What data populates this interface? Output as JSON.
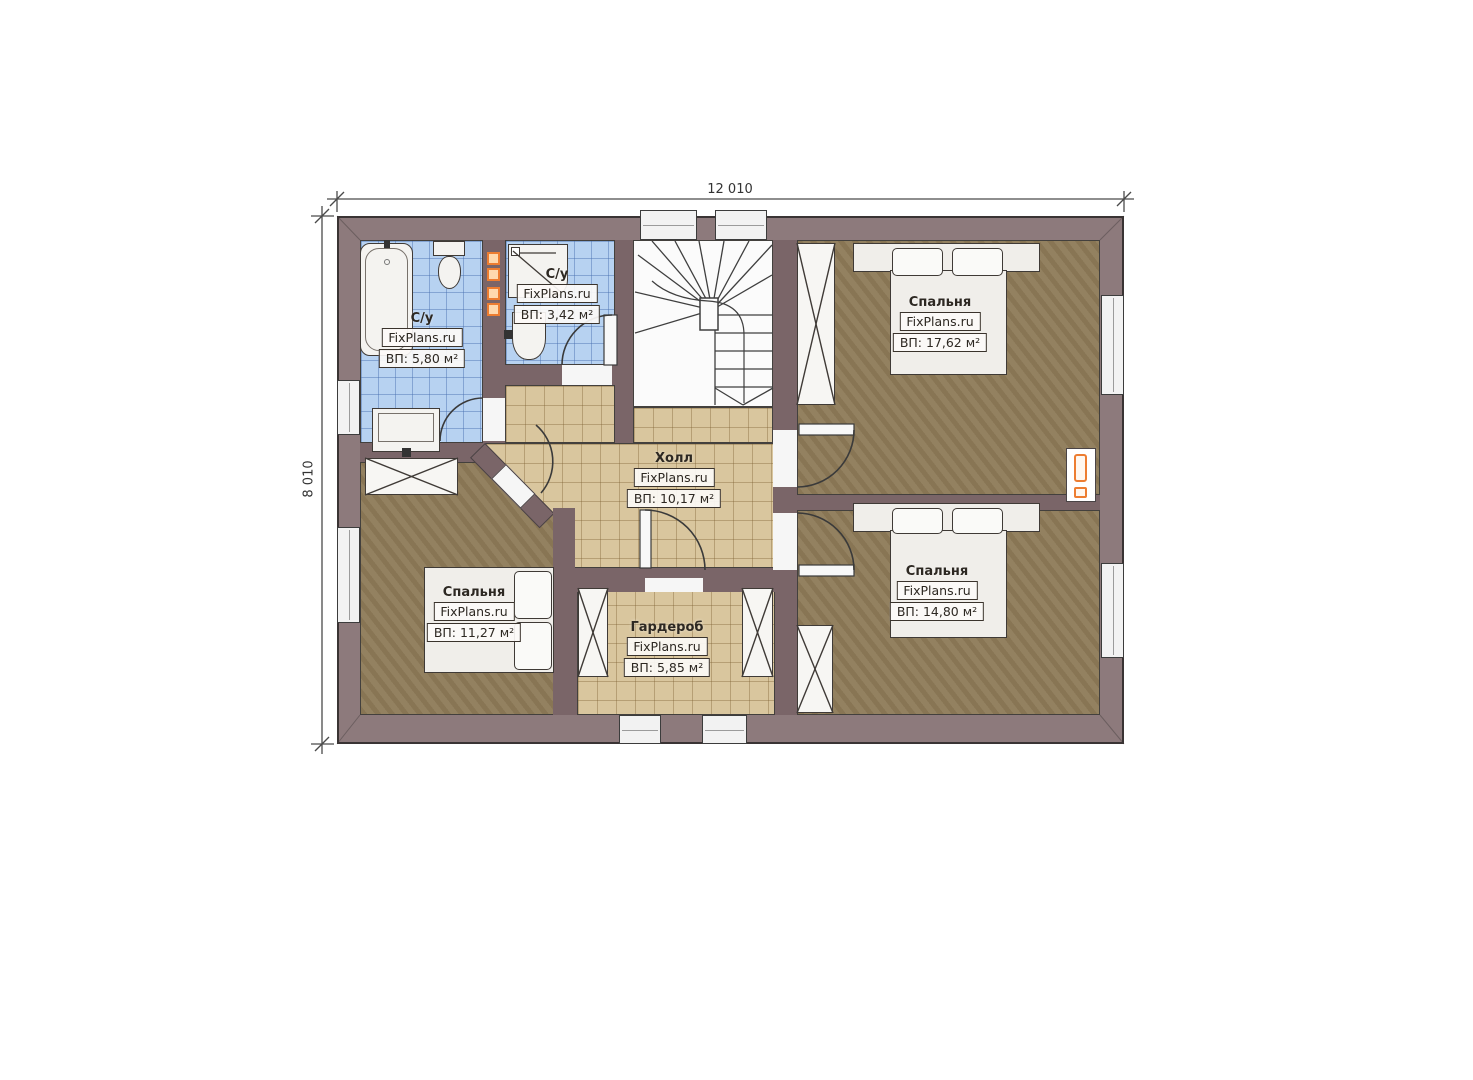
{
  "plan": {
    "watermark": "FixPlans.ru",
    "dimension_width": "12 010",
    "dimension_height": "8 010",
    "rooms": [
      {
        "id": "bathroom-top-left",
        "name": "С/у",
        "area": "ВП: 5,80 м²"
      },
      {
        "id": "bathroom-top-middle",
        "name": "С/у",
        "area": "ВП: 3,42 м²"
      },
      {
        "id": "bedroom-top-right",
        "name": "Спальня",
        "area": "ВП: 17,62 м²"
      },
      {
        "id": "hall",
        "name": "Холл",
        "area": "ВП: 10,17 м²"
      },
      {
        "id": "bedroom-bottom-left",
        "name": "Спальня",
        "area": "ВП: 11,27 м²"
      },
      {
        "id": "wardrobe",
        "name": "Гардероб",
        "area": "ВП: 5,85 м²"
      },
      {
        "id": "bedroom-bottom-right",
        "name": "Спальня",
        "area": "ВП: 14,80 м²"
      }
    ],
    "colors": {
      "exterior_wall": "#8d7a7c",
      "interior_wall": "#7a6568",
      "bathroom_tile": "#b7d2f1",
      "hall_tile": "#d9c69e",
      "bedroom_floor": "#8d7a58",
      "accent_orange": "#ed7d31"
    }
  }
}
